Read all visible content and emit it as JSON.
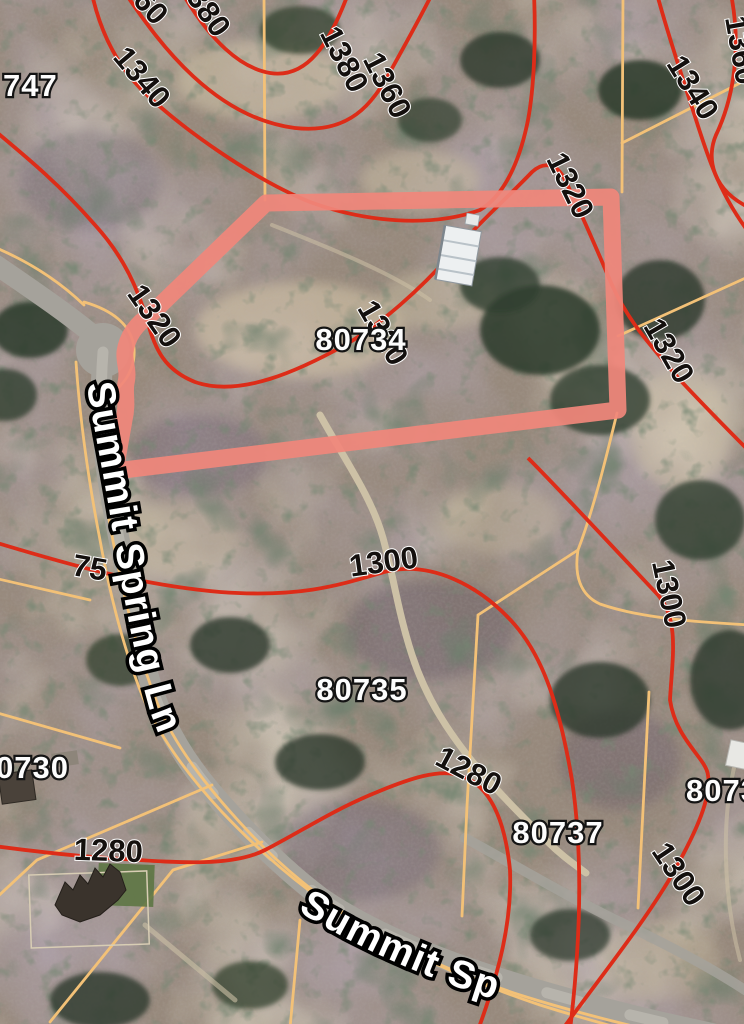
{
  "map_type": "satellite-parcel-map",
  "colors": {
    "contour": "#dd2c18",
    "parcel_line": "#f3c177",
    "highlight": "#f0877b",
    "road": "#a5a29b",
    "road_wear": "#c9c6bd",
    "trail": "#cdc1a6",
    "ground": "#97897c"
  },
  "highlighted_parcel": {
    "lot": "80734"
  },
  "street_labels": [
    {
      "text": "Summit Spring Ln"
    },
    {
      "text": "Summit Sp"
    }
  ],
  "parcel_labels": [
    {
      "text": "747",
      "x": 3,
      "y": 96,
      "anchor": "start"
    },
    {
      "text": "80734",
      "x": 361,
      "y": 350,
      "anchor": "middle"
    },
    {
      "text": "80735",
      "x": 362,
      "y": 700,
      "anchor": "middle"
    },
    {
      "text": "0730",
      "x": -4,
      "y": 778,
      "anchor": "start"
    },
    {
      "text": "80737",
      "x": 558,
      "y": 843,
      "anchor": "middle"
    },
    {
      "text": "8073",
      "x": 686,
      "y": 801,
      "anchor": "start"
    }
  ],
  "contour_labels": [
    {
      "text": "60",
      "x": 143,
      "y": 14,
      "rot": 48
    },
    {
      "text": "380",
      "x": 200,
      "y": 18,
      "rot": 55
    },
    {
      "text": "1340",
      "x": 134,
      "y": 84,
      "rot": 50
    },
    {
      "text": "1380",
      "x": 335,
      "y": 64,
      "rot": 63
    },
    {
      "text": "1360",
      "x": 378,
      "y": 90,
      "rot": 63
    },
    {
      "text": "1360",
      "x": 731,
      "y": 52,
      "rot": 80
    },
    {
      "text": "1340",
      "x": 684,
      "y": 93,
      "rot": 58
    },
    {
      "text": "1320",
      "x": 146,
      "y": 322,
      "rot": 55
    },
    {
      "text": "1320",
      "x": 374,
      "y": 338,
      "rot": 60
    },
    {
      "text": "1320",
      "x": 561,
      "y": 190,
      "rot": 64
    },
    {
      "text": "1320",
      "x": 660,
      "y": 356,
      "rot": 60
    },
    {
      "text": "1300",
      "x": 385,
      "y": 572,
      "rot": -8
    },
    {
      "text": "1300",
      "x": 659,
      "y": 596,
      "rot": 78
    },
    {
      "text": "1300",
      "x": 670,
      "y": 880,
      "rot": 56
    },
    {
      "text": "1280",
      "x": 108,
      "y": 861,
      "rot": 2
    },
    {
      "text": "1280",
      "x": 464,
      "y": 780,
      "rot": 28
    },
    {
      "text": "75",
      "x": 88,
      "y": 578,
      "rot": 10
    }
  ]
}
